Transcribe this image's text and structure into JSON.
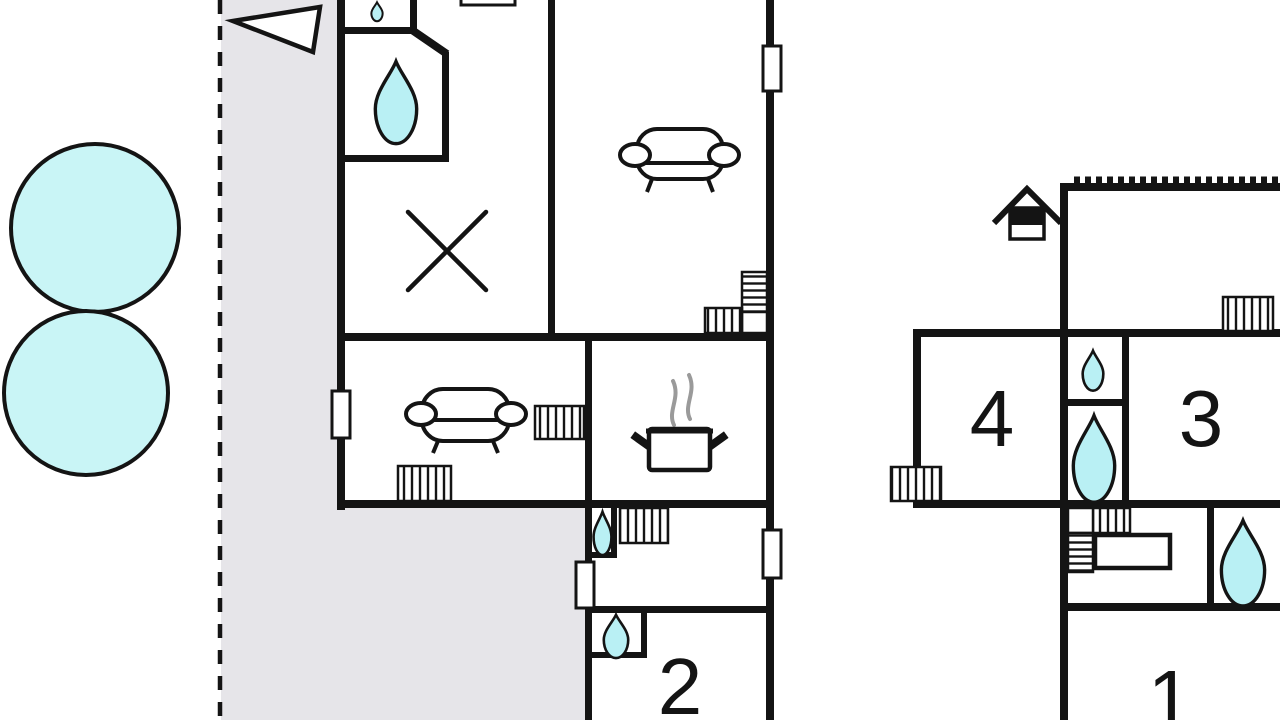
{
  "plan": {
    "type": "vacation-home-floor-plan",
    "labels": {
      "room1": "1",
      "room2": "2",
      "room3": "3",
      "room4": "4"
    },
    "colors": {
      "paper": "#ffffff",
      "wall": "#141414",
      "water": "#b9f0f4",
      "pool": "#c9f5f6",
      "terrace": "#e6e5e9",
      "steam": "#9a9a9a"
    },
    "icons": [
      "pool",
      "terrace-boundary",
      "north-arrow-icon",
      "house-icon",
      "water-drop-icon",
      "sofa-icon",
      "cooking-pot-icon",
      "steam-icon",
      "x-mark-icon",
      "staircase",
      "radiator",
      "window",
      "counter"
    ]
  }
}
